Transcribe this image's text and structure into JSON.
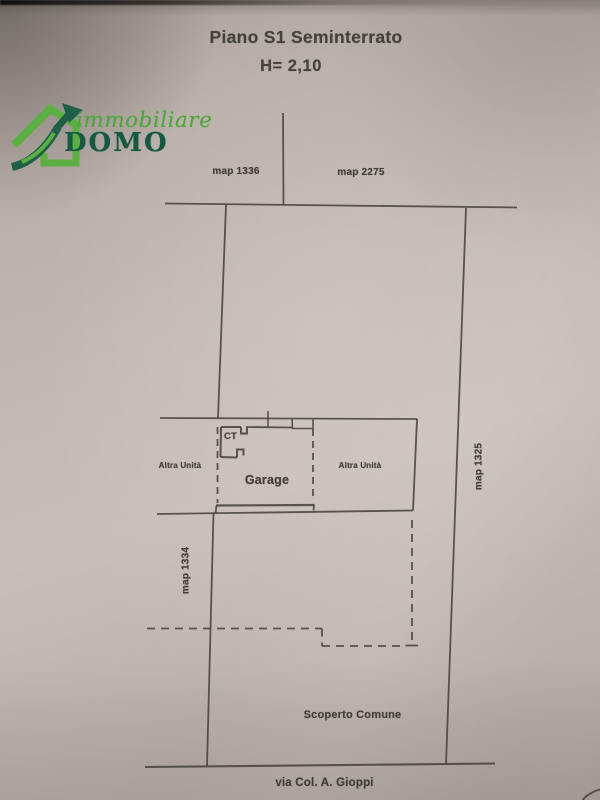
{
  "photo": {
    "paper_color": "#c2b9b2"
  },
  "logo": {
    "immobiliare": "immobiliare",
    "domo": "DOMO",
    "light_green": "#5cb043",
    "dark_green": "#1f5f48"
  },
  "title": {
    "floor": "Piano S1 Seminterrato",
    "height": "H= 2,10"
  },
  "plan": {
    "line_color": "#48433e",
    "parcels": {
      "map_1336": "map 1336",
      "map_2275": "map 2275",
      "map_1325": "map 1325",
      "map_1334": "map 1334"
    },
    "rooms": {
      "ct": "CT",
      "garage": "Garage",
      "altra_unita_left": "Altra Unità",
      "altra_unita_right": "Altra Unità"
    },
    "areas": {
      "scoperto_comune": "Scoperto Comune"
    },
    "street": {
      "name": "via Col. A. Gioppi"
    }
  }
}
